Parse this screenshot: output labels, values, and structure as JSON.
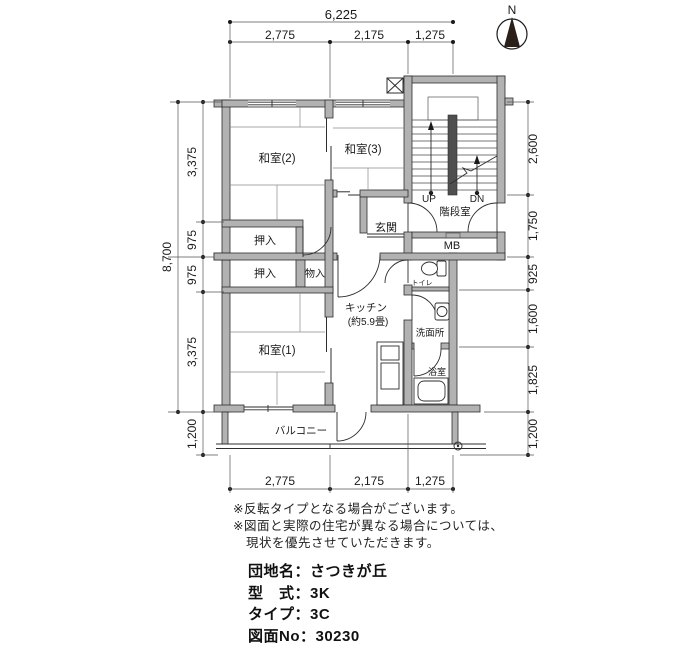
{
  "compass": {
    "north": "N"
  },
  "dimensions": {
    "top_total": "6,225",
    "top": [
      "2,775",
      "2,175",
      "1,275"
    ],
    "bottom": [
      "2,775",
      "2,175",
      "1,275"
    ],
    "left_total": "8,700",
    "left": [
      "3,375",
      "975",
      "975",
      "3,375",
      "1,200"
    ],
    "right": [
      "2,600",
      "1,750",
      "925",
      "1,600",
      "1,825",
      "1,200"
    ]
  },
  "rooms": {
    "washitsu2": "和室(2)",
    "washitsu3": "和室(3)",
    "washitsu1": "和室(1)",
    "oshiire_upper": "押入",
    "oshiire_lower": "押入",
    "monoire": "物入",
    "genkan": "玄関",
    "kitchen": "キッチン",
    "kitchen_size": "(約5.9畳)",
    "toilet": "トイレ",
    "washroom": "洗面所",
    "bathroom": "浴室",
    "balcony": "バルコニー"
  },
  "stairwell": {
    "label": "階段室",
    "up": "UP",
    "down": "DN",
    "meter_box": "MB"
  },
  "notes": [
    "※反転タイプとなる場合がございます。",
    "※図面と実際の住宅が異なる場合については、",
    "現状を優先させていただきます。"
  ],
  "info": {
    "lines": [
      "団地名：さつきが丘",
      "型　式：3K",
      "タイプ：3C",
      "図面No：30230"
    ]
  }
}
